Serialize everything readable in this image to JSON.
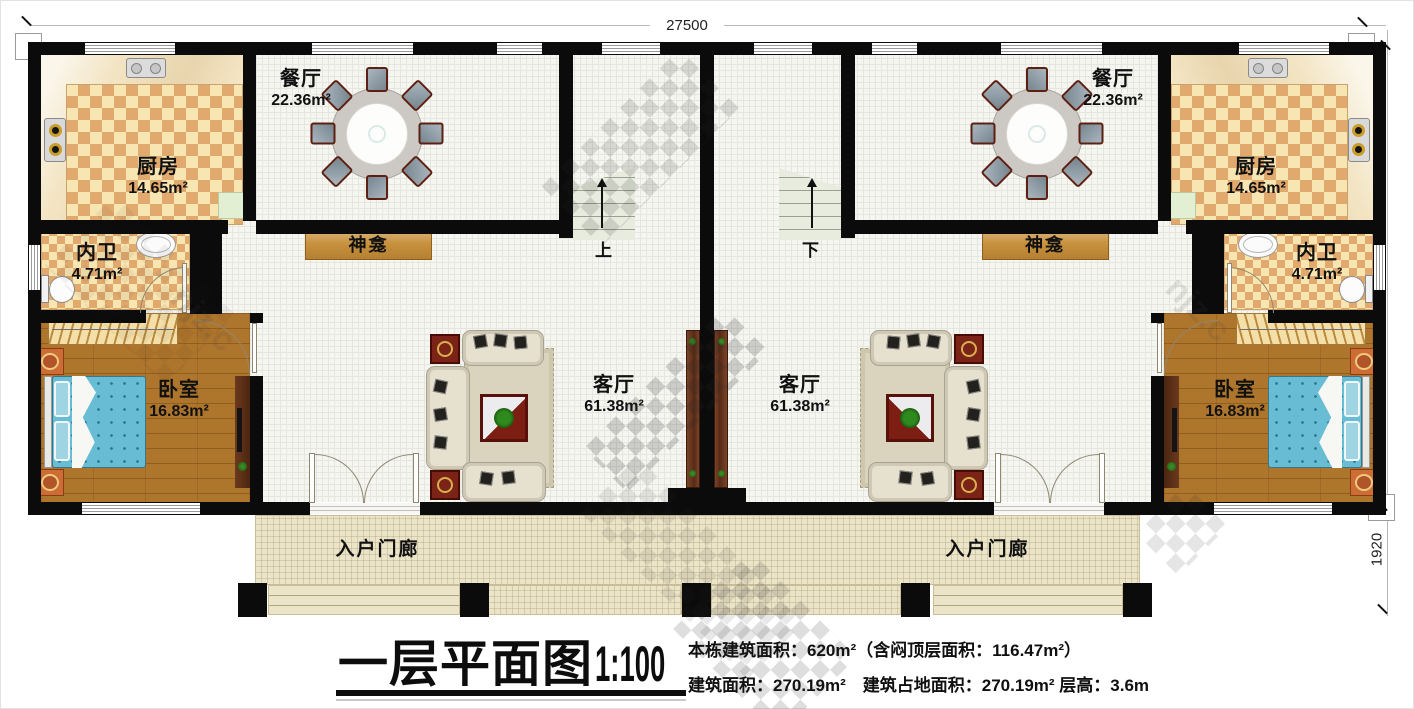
{
  "dims": {
    "width": "27500",
    "height_main": "9500",
    "height_porch": "1920"
  },
  "rooms": {
    "dining": {
      "name": "餐厅",
      "area": "22.36m²"
    },
    "kitchen": {
      "name": "厨房",
      "area": "14.65m²"
    },
    "bath": {
      "name": "内卫",
      "area": "4.71m²"
    },
    "bedroom": {
      "name": "卧室",
      "area": "16.83m²"
    },
    "living": {
      "name": "客厅",
      "area": "61.38m²"
    },
    "shrine": {
      "name": "神龛"
    },
    "porch": {
      "name": "入户门廊"
    }
  },
  "stairs": {
    "left": "上",
    "right": "下"
  },
  "title_block": {
    "title": "一层平面图",
    "scale": "1:100",
    "line1": "本栋建筑面积：620m²（含闷顶层面积：116.47m²）",
    "line2": "建筑面积：270.19m²　建筑占地面积：270.19m² 层高：3.6m"
  },
  "watermark": {
    "fragment": "njz.c"
  },
  "colors": {
    "wall": "#0b0b0b",
    "tile_tan": "#e1a96d",
    "tile_cream": "#f7e5b2",
    "wood_floor": "#ae752c",
    "bed_blue": "#68bcd4",
    "shrine_wood": "#c8913d",
    "porch_tile": "#ece4c8",
    "stair_green": "#e8ecdf"
  }
}
